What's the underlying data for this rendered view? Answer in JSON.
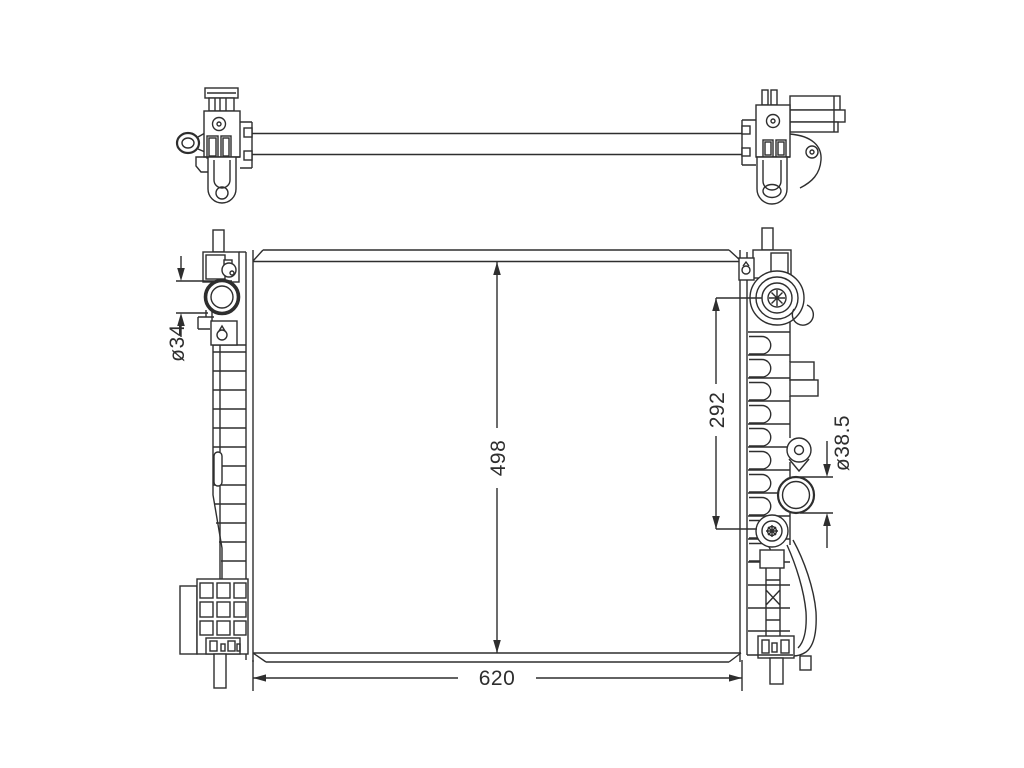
{
  "drawing": {
    "colors": {
      "background": "#ffffff",
      "line": "#2e2e2e"
    }
  },
  "dimensions": {
    "inlet_diameter": {
      "label": "ø34"
    },
    "port_spacing": {
      "label": "292"
    },
    "outlet_diameter": {
      "label": "ø38.5"
    },
    "core_height": {
      "label": "498"
    },
    "core_width": {
      "label": "620"
    }
  }
}
